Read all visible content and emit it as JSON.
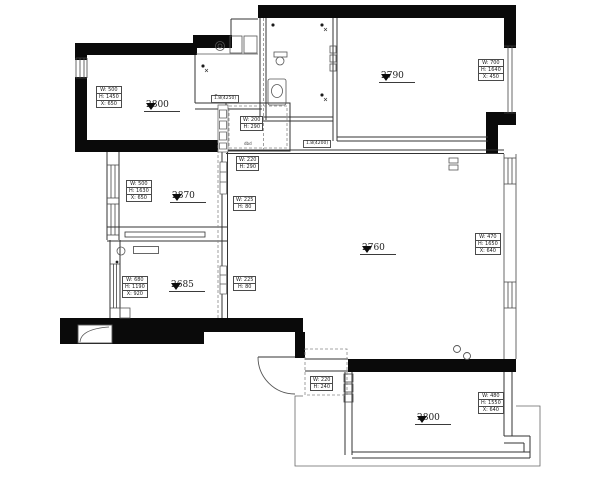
{
  "plan": {
    "rooms": [
      {
        "id": "top-left",
        "number": "2800",
        "dims": [
          "W: 500",
          "H: 1450",
          "X: 650"
        ]
      },
      {
        "id": "top-right",
        "number": "2790",
        "dims": [
          "W: 700",
          "H: 1640",
          "X: 450"
        ]
      },
      {
        "id": "mid-left",
        "number": "2870",
        "dims": [
          "W: 500",
          "H: 1630",
          "X: 650"
        ]
      },
      {
        "id": "lower-left",
        "number": "2685",
        "dims": [
          "W: 680",
          "H: 1190",
          "X: 920"
        ]
      },
      {
        "id": "living",
        "number": "2760",
        "dims": [
          "W: 470",
          "H: 1650",
          "X: 640"
        ]
      },
      {
        "id": "bottom-right",
        "number": "2800",
        "dims": [
          "W: 480",
          "H: 1550",
          "X: 640"
        ]
      }
    ],
    "beam_tags": [
      {
        "id": "foyer-upper",
        "dims": [
          "W: 200",
          "H: 290"
        ]
      },
      {
        "id": "foyer-lower",
        "dims": [
          "W: 220",
          "H: 290"
        ]
      },
      {
        "id": "wall-mid",
        "dims": [
          "W: 225",
          "H: 80"
        ]
      },
      {
        "id": "wall-lower",
        "dims": [
          "W: 225",
          "H: 80"
        ]
      },
      {
        "id": "entry",
        "dims": [
          "W: 220",
          "H: 240"
        ]
      }
    ],
    "notes": {
      "kitchen_dim": "1.8(4250)",
      "hall_dim": "1.8(4200)",
      "tiny": "dbd"
    }
  }
}
